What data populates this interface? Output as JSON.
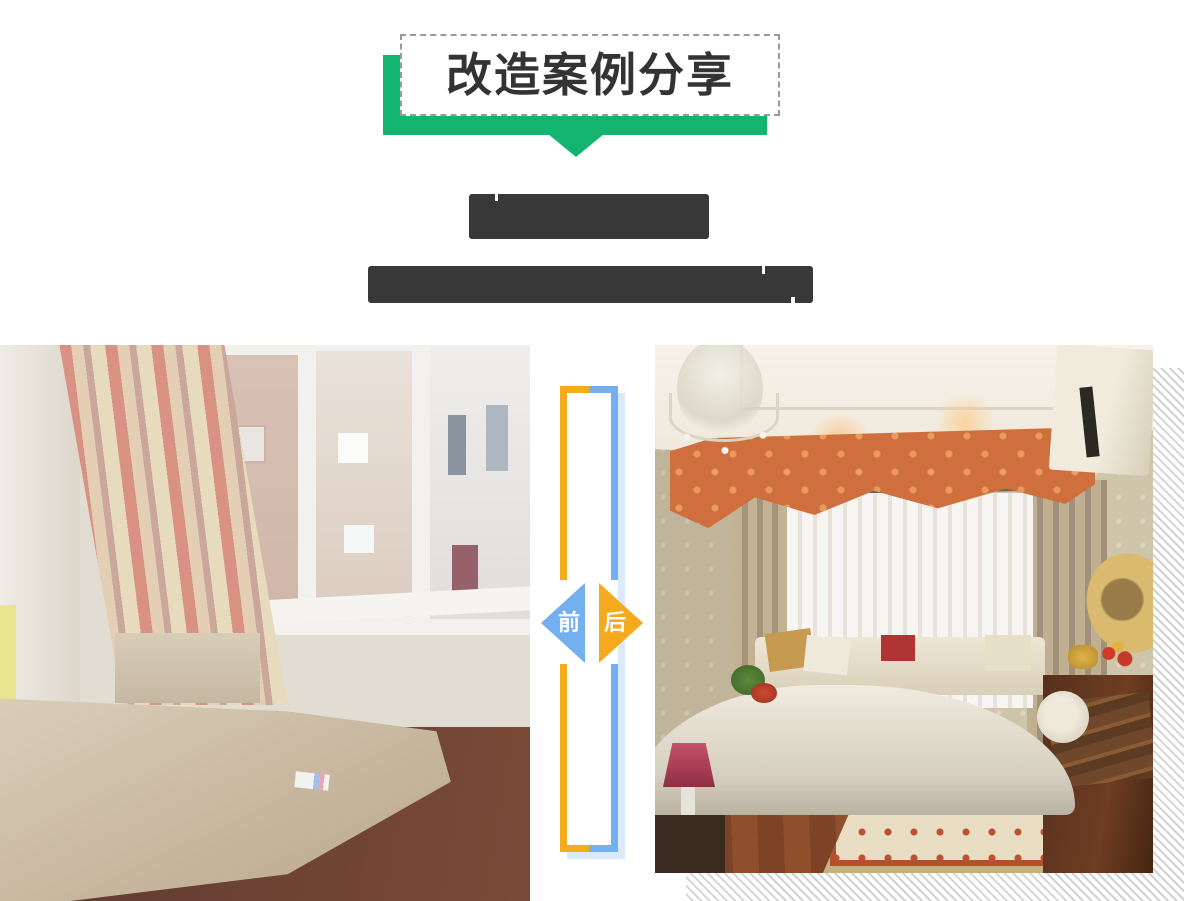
{
  "header": {
    "title": "改造案例分享",
    "accent_green": "#12B46F",
    "box_border_color": "#9A9A9A",
    "title_color": "#333333"
  },
  "case_heading": {
    "title_redacted": true,
    "subtitle_redacted": true,
    "redaction_color": "#383838"
  },
  "comparison": {
    "before_label": "前",
    "after_label": "后",
    "before_badge_color": "#74B0F0",
    "after_badge_color": "#F5A91D",
    "frame_left_color": "#F5AB1E",
    "frame_right_color": "#74B0F0",
    "frame_shadow_color": "#DAE9FB",
    "hatch_color": "#D2D2D2",
    "before_photo": "bedroom-before-renovation-photo",
    "after_photo": "bedroom-after-renovation-photo"
  }
}
